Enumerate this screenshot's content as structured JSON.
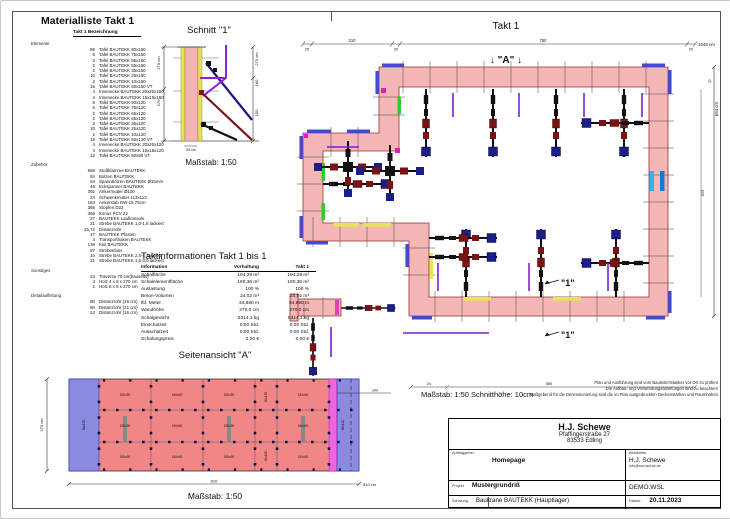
{
  "material_list": {
    "title": "Materialliste  Takt 1",
    "subtitle": "Takt 1  Bezeichnung",
    "sections": {
      "elemente": {
        "label": "Elemente",
        "rows": [
          {
            "q": "86",
            "n": "Tafel BAUTEKK  90x150"
          },
          {
            "q": "6",
            "n": "Tafel BAUTEKK  75x150"
          },
          {
            "q": "2",
            "n": "Tafel BAUTEKK  65x150"
          },
          {
            "q": "2",
            "n": "Tafel BAUTEKK  55x150"
          },
          {
            "q": "2",
            "n": "Tafel BAUTEKK  35x150"
          },
          {
            "q": "10",
            "n": "Tafel BAUTEKK  25x150"
          },
          {
            "q": "2",
            "n": "Tafel BAUTEKK  10x150"
          },
          {
            "q": "16",
            "n": "Tafel BAUTEKK  60x150 VT"
          },
          {
            "q": "4",
            "n": "Innenecke BAUTEKK 20x20x150"
          },
          {
            "q": "4",
            "n": "Innenecke BAUTEKK 15x15x150"
          },
          {
            "q": "6",
            "n": "Tafel BAUTEKK  90x120"
          },
          {
            "q": "6",
            "n": "Tafel BAUTEKK  75x120"
          },
          {
            "q": "2",
            "n": "Tafel BAUTEKK  65x120"
          },
          {
            "q": "2",
            "n": "Tafel BAUTEKK  55x120"
          },
          {
            "q": "2",
            "n": "Tafel BAUTEKK  35x120"
          },
          {
            "q": "10",
            "n": "Tafel BAUTEKK  25x120"
          },
          {
            "q": "2",
            "n": "Tafel BAUTEKK  10x120"
          },
          {
            "q": "16",
            "n": "Tafel BAUTEKK  60x120 VT"
          },
          {
            "q": "4",
            "n": "Innenecke BAUTEKK 20x20x120"
          },
          {
            "q": "4",
            "n": "Innenecke BAUTEKK 15x15x120"
          },
          {
            "q": "12",
            "n": "Tafel BAUTEKK  60x90 VT"
          }
        ]
      },
      "zubehoer": {
        "label": "Zubehör",
        "rows": [
          {
            "q": "566",
            "n": "Stoßklamme BAUTEKK"
          },
          {
            "q": "84",
            "n": "Bolzen BAUTEKK"
          },
          {
            "q": "54",
            "n": "Spannbolzen BAUTEKK Ø15mm"
          },
          {
            "q": "46",
            "n": "Eckspanner BAUTEKK"
          },
          {
            "q": "392",
            "n": "Ankermutter Ø100"
          },
          {
            "q": "24",
            "n": "Schwenkmutter 113x113"
          },
          {
            "q": "184",
            "n": "Ankerstab DW-15 75cm"
          },
          {
            "q": "366",
            "n": "Stopfen D22"
          },
          {
            "q": "366",
            "n": "Konus PCV 22"
          },
          {
            "q": "27",
            "n": "BAUTEKK Laufkonsole"
          },
          {
            "q": "21",
            "n": "Strebe BAUTEKK 1,0-1,8 lackiert"
          },
          {
            "q": "26,72",
            "n": "Distanzrohr"
          },
          {
            "q": "27",
            "n": "BAUTEKK Pfosten"
          },
          {
            "q": "4",
            "n": "Transporthaken BAUTEKK"
          },
          {
            "q": "138",
            "n": "Keil BAUTEKK"
          },
          {
            "q": "87",
            "n": "Strebenfuss"
          },
          {
            "q": "16",
            "n": "Strebe BAUTEKK 2,5-4, lackiert"
          },
          {
            "q": "21",
            "n": "Strebe BAUTEKK 1,5-3,0 lackiert"
          }
        ]
      },
      "sonstiges": {
        "label": "Sonstiges",
        "rows": [
          {
            "q": "24",
            "n": "Traverse 70 cm(bauseits)"
          },
          {
            "q": "4",
            "n": "Holz 4 x 8 x 270 cm"
          },
          {
            "q": "2",
            "n": "Holz 6 x 8 x 270 cm"
          }
        ]
      },
      "detail": {
        "label": "Detailauflistung",
        "rows": [
          {
            "q": "80",
            "n": "Distanzrohr (26 cm)"
          },
          {
            "q": "80",
            "n": "Distanzrohr (21 cm)"
          },
          {
            "q": "24",
            "n": "Distanzrohr (16 cm)"
          }
        ]
      }
    }
  },
  "schnitt": {
    "title": "Schnitt \"1\"",
    "scale": "Maßstab: 1:50",
    "dim_left_total": "270 cm",
    "dim_left_seg": "270",
    "dim_right_total": "270 cm",
    "dim_right_seg1": "180",
    "dim_right_seg2": "150",
    "dim_bottom": "25 cm"
  },
  "takt_info": {
    "title": "Taktinformationen  Takt 1 bis 1",
    "col_info": "Information",
    "col_vorhaltung": "Vorhaltung",
    "col_takt": "Takt 1",
    "rows": [
      {
        "n": "Schalfläche",
        "v": "194,29 m²",
        "t": "194,29 m²"
      },
      {
        "n": "Schalelementfläche",
        "v": "180,36 m²",
        "t": "180,36 m²"
      },
      {
        "n": "Auslastung",
        "v": "100 %",
        "t": "100 %"
      },
      {
        "n": "Beton-Volumen",
        "v": "24,02 m³",
        "t": "24,02 m³"
      },
      {
        "n": "lfd. Meter",
        "v": "34,880 m",
        "t": "34,880 m"
      },
      {
        "n": "Wandhöhe",
        "v": "270,0 cm",
        "t": "270,0 cm"
      },
      {
        "n": "Schalgewicht",
        "v": "5314,1 kg",
        "t": "5314,1 kg"
      },
      {
        "n": "Einschalzeit",
        "v": "0:00 Std.",
        "t": "0:00 Std."
      },
      {
        "n": "Ausschalzeit",
        "v": "0:00 Std.",
        "t": "0:00 Std."
      },
      {
        "n": "Schalungspreis",
        "v": "0,00 €",
        "t": "0,00 €"
      }
    ]
  },
  "plan": {
    "title": "Takt 1",
    "marker_a": "↓ \"A\" ↓",
    "marker_1": "\"1\"",
    "dims": {
      "d25": "25",
      "d210": "210",
      "d20a": "20",
      "d750": "750",
      "d20b": "20",
      "total": "1045 cm",
      "right": "664 cm",
      "right_tick": "30",
      "inner_right": "629",
      "bottom_a": "24",
      "bottom_b": "585",
      "stub_a": "25",
      "stub_b": "15"
    }
  },
  "elevation": {
    "title": "Seitenansicht \"A\"",
    "scale": "Maßstab: 1:50",
    "dim_bottom_seg": "810",
    "dim_bottom_total": "810 cm",
    "dim_left": "270 cm",
    "dim_right": "200",
    "label_blue": "60x120",
    "label_pink": "150x90",
    "label_narrow": "90x150"
  },
  "notes": {
    "scale_line": "Maßstab: 1:50   Schnitthöhe: 10cm",
    "line1": "Plan und Ausführung sind vom Bauleiter/Statiker vor Ort zu prüfen!",
    "line2": "Die Aufbau- und Verwendungsanleitungen sind zu beachten!",
    "line3": "Maßgebend für die Dimensionierung sind die im Plan ausgedruckten Deckenstärken und Raumhöhen"
  },
  "title_block": {
    "company": "H.J. Schewe",
    "street": "Pfaffingerstraße 27",
    "city": "83533 Edling",
    "lbl_auftraggeber": "Auftraggeber",
    "auftraggeber": "Homepage",
    "lbl_bearbeiter": "Bearbeiter",
    "bearbeiter": "H.J. Schewe",
    "email": "info@euroschal.de",
    "lbl_projekt": "Projekt",
    "projekt": "Mustergrundriß",
    "file": "DEMO.WSL",
    "lbl_schalung": "Schalung",
    "schalung": "Baukrane BAUTEKK (Hauptlager)",
    "lbl_datum": "Datum:",
    "datum": "20.11.2023"
  }
}
